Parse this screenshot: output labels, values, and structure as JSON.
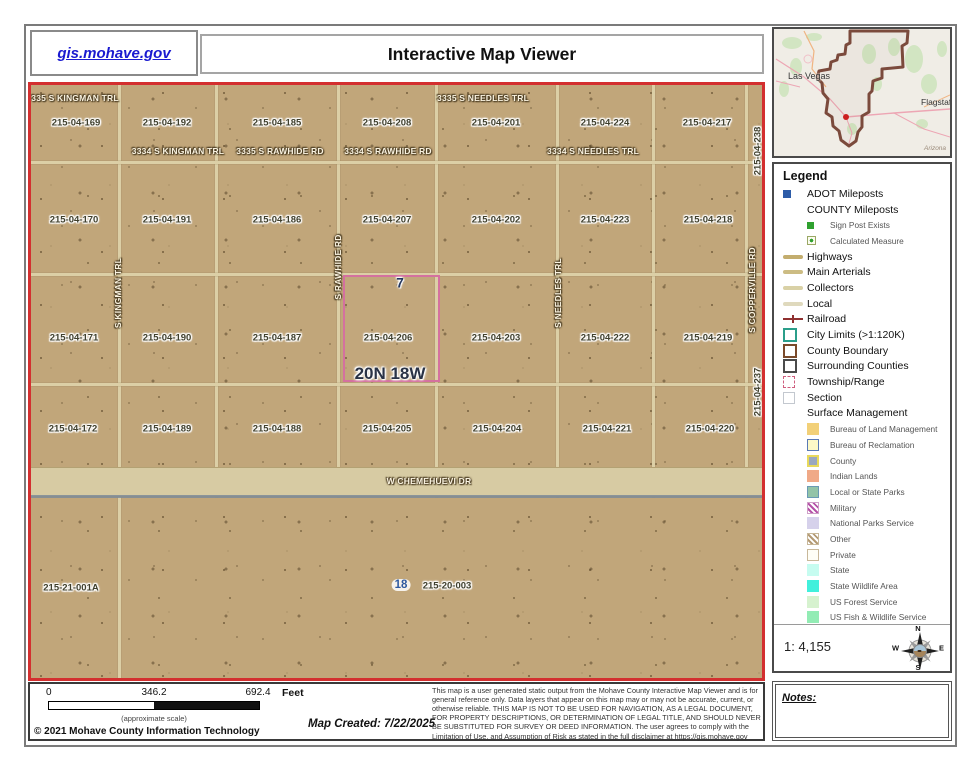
{
  "header": {
    "site_link": "gis.mohave.gov",
    "title": "Interactive Map Viewer"
  },
  "overview": {
    "city": "Las Vegas",
    "city_right": "Flagstaff",
    "state": "Arizona"
  },
  "colors": {
    "map_border": "#d32f2f",
    "township_pink": "#d4719f",
    "county_outline": "#7b4a3c",
    "marker_red": "#cc1f1f"
  },
  "legend": {
    "title": "Legend",
    "scale_text": "1: 4,155",
    "items": [
      {
        "label": "ADOT Mileposts",
        "swatch": {
          "kind": "sqs2",
          "name": "adot-milepost-swatch",
          "css": "background:#2d5ca8"
        }
      },
      {
        "label": "COUNTY Mileposts",
        "swatch": null
      },
      {
        "label": "Sign Post Exists",
        "indent": 1,
        "small": true,
        "swatch": {
          "kind": "sqs",
          "name": "sign-post-swatch",
          "css": "background:#2fa12f"
        }
      },
      {
        "label": "Calculated Measure",
        "indent": 1,
        "small": true,
        "swatch": {
          "kind": "sqs",
          "name": "calculated-measure-swatch",
          "css": "border:1px solid #9aa865;background-color:#fbfbef;background-image:radial-gradient(circle 2px at 50% 50%,#2fa12f 85%,rgba(0,0,0,0) 95%)"
        }
      },
      {
        "label": "Highways",
        "swatch": {
          "kind": "line",
          "name": "highways-swatch",
          "css": "background:#c3ad6e"
        }
      },
      {
        "label": "Main Arterials",
        "swatch": {
          "kind": "line",
          "name": "main-arterials-swatch",
          "css": "background:#ccbc83"
        }
      },
      {
        "label": "Collectors",
        "swatch": {
          "kind": "line",
          "name": "collectors-swatch",
          "css": "background:#d9d1a6"
        }
      },
      {
        "label": "Local",
        "swatch": {
          "kind": "line",
          "name": "local-swatch",
          "css": "background:#dfd9bd"
        }
      },
      {
        "label": "Railroad",
        "swatch": {
          "kind": "rail",
          "name": "railroad-swatch",
          "css": "background:#8f3030"
        }
      },
      {
        "label": "City Limits (>1:120K)",
        "swatch": {
          "kind": "osq",
          "name": "city-limits-swatch",
          "css": "border-color:#2b9e8a"
        }
      },
      {
        "label": "County Boundary",
        "swatch": {
          "kind": "osq",
          "name": "county-boundary-swatch",
          "css": "border-color:#7a4a2a"
        }
      },
      {
        "label": "Surrounding Counties",
        "swatch": {
          "kind": "osq",
          "name": "surrounding-counties-swatch",
          "css": "border-color:#4a4a4a"
        }
      },
      {
        "label": "Township/Range",
        "swatch": {
          "kind": "osq",
          "name": "township-range-swatch",
          "css": "border-color:#cf5f7f;border-width:1px;border-style:dashed"
        }
      },
      {
        "label": "Section",
        "swatch": {
          "kind": "osq",
          "name": "section-swatch",
          "css": "border-color:#c3c8cf;border-width:1px"
        }
      },
      {
        "label": "Surface Management",
        "heading": true,
        "swatch": null
      },
      {
        "label": "Bureau of Land Management",
        "indent": 1,
        "small": true,
        "swatch": {
          "kind": "sqm",
          "name": "blm-swatch",
          "css": "background:#f2d078"
        }
      },
      {
        "label": "Bureau of Reclamation",
        "indent": 1,
        "small": true,
        "swatch": {
          "kind": "sqm",
          "name": "bureau-reclamation-swatch",
          "css": "background:#fdf9c8;border:1px solid #5a7ab5"
        }
      },
      {
        "label": "County",
        "indent": 1,
        "small": true,
        "swatch": {
          "kind": "sqm",
          "name": "county-swatch",
          "css": "background:#9aa8bf;border:2px solid #e8d95c"
        }
      },
      {
        "label": "Indian Lands",
        "indent": 1,
        "small": true,
        "swatch": {
          "kind": "sqm",
          "name": "indian-lands-swatch",
          "css": "background:#f0a987"
        }
      },
      {
        "label": "Local or State Parks",
        "indent": 1,
        "small": true,
        "swatch": {
          "kind": "sqm",
          "name": "state-parks-swatch",
          "css": "background:#93c4a8;border:1px solid #6a9ab5"
        }
      },
      {
        "label": "Military",
        "indent": 1,
        "small": true,
        "swatch": {
          "kind": "sqm",
          "name": "military-swatch",
          "css": "background:repeating-linear-gradient(45deg,#fff 0 2px,#b553a8 2px 4px);border:1px solid #cfa0c8"
        }
      },
      {
        "label": "National Parks Service",
        "indent": 1,
        "small": true,
        "swatch": {
          "kind": "sqm",
          "name": "nps-swatch",
          "css": "background:#d6d1eb"
        }
      },
      {
        "label": "Other",
        "indent": 1,
        "small": true,
        "swatch": {
          "kind": "sqm",
          "name": "other-swatch",
          "css": "background:repeating-linear-gradient(45deg,#fff 0 2px,#b49a74 2px 4px);border:1px solid #c8b89a"
        }
      },
      {
        "label": "Private",
        "indent": 1,
        "small": true,
        "swatch": {
          "kind": "sqm",
          "name": "private-swatch",
          "css": "background:#fffef6;border:1px solid #c8b89a"
        }
      },
      {
        "label": "State",
        "indent": 1,
        "small": true,
        "swatch": {
          "kind": "sqm",
          "name": "state-swatch",
          "css": "background:#c6fcf0"
        }
      },
      {
        "label": "State Wildlife Area",
        "indent": 1,
        "small": true,
        "swatch": {
          "kind": "sqm",
          "name": "state-wildlife-swatch",
          "css": "background:#41f0dc"
        }
      },
      {
        "label": "US Forest Service",
        "indent": 1,
        "small": true,
        "swatch": {
          "kind": "sqm",
          "name": "us-forest-swatch",
          "css": "background:#d6f2cf"
        }
      },
      {
        "label": "US Fish & Wildlife Service",
        "indent": 1,
        "small": true,
        "swatch": {
          "kind": "sqm",
          "name": "us-fish-wildlife-swatch",
          "css": "background:#92ecb4"
        }
      }
    ]
  },
  "compass": {
    "n": "N",
    "e": "E",
    "s": "S",
    "w": "W"
  },
  "notes": {
    "label": "Notes:"
  },
  "map": {
    "labels": [
      {
        "t": "335 S KINGMAN TRL",
        "x": 44,
        "y": 13,
        "c": "s"
      },
      {
        "t": "3335 S NEEDLES TRL",
        "x": 452,
        "y": 13,
        "c": "s"
      },
      {
        "t": "3334 S KINGMAN TRL",
        "x": 147,
        "y": 66,
        "c": "s"
      },
      {
        "t": "3335 S RAWHIDE RD",
        "x": 249,
        "y": 66,
        "c": "s"
      },
      {
        "t": "3334 S RAWHIDE RD",
        "x": 357,
        "y": 66,
        "c": "s"
      },
      {
        "t": "3334 S NEEDLES TRL",
        "x": 562,
        "y": 66,
        "c": "s"
      },
      {
        "t": "W CHEMEHUEVI DR",
        "x": 398,
        "y": 396,
        "c": "s"
      },
      {
        "t": "S KINGMAN TRL",
        "x": 87,
        "y": 208,
        "c": "s v"
      },
      {
        "t": "S RAWHIDE RD",
        "x": 307,
        "y": 182,
        "c": "s v"
      },
      {
        "t": "S NEEDLES TRL",
        "x": 527,
        "y": 208,
        "c": "s v"
      },
      {
        "t": "S COPPERVILLE RD",
        "x": 721,
        "y": 205,
        "c": "s v"
      },
      {
        "t": "215-04-169",
        "x": 45,
        "y": 38,
        "c": "p"
      },
      {
        "t": "215-04-192",
        "x": 136,
        "y": 38,
        "c": "p"
      },
      {
        "t": "215-04-185",
        "x": 246,
        "y": 38,
        "c": "p"
      },
      {
        "t": "215-04-208",
        "x": 356,
        "y": 38,
        "c": "p"
      },
      {
        "t": "215-04-201",
        "x": 465,
        "y": 38,
        "c": "p"
      },
      {
        "t": "215-04-224",
        "x": 574,
        "y": 38,
        "c": "p"
      },
      {
        "t": "215-04-217",
        "x": 676,
        "y": 38,
        "c": "p"
      },
      {
        "t": "215-04-170",
        "x": 43,
        "y": 135,
        "c": "p"
      },
      {
        "t": "215-04-191",
        "x": 136,
        "y": 135,
        "c": "p"
      },
      {
        "t": "215-04-186",
        "x": 246,
        "y": 135,
        "c": "p"
      },
      {
        "t": "215-04-207",
        "x": 356,
        "y": 135,
        "c": "p"
      },
      {
        "t": "215-04-202",
        "x": 465,
        "y": 135,
        "c": "p"
      },
      {
        "t": "215-04-223",
        "x": 574,
        "y": 135,
        "c": "p"
      },
      {
        "t": "215-04-218",
        "x": 677,
        "y": 135,
        "c": "p"
      },
      {
        "t": "215-04-171",
        "x": 43,
        "y": 253,
        "c": "p"
      },
      {
        "t": "215-04-190",
        "x": 136,
        "y": 253,
        "c": "p"
      },
      {
        "t": "215-04-187",
        "x": 246,
        "y": 253,
        "c": "p"
      },
      {
        "t": "215-04-206",
        "x": 357,
        "y": 253,
        "c": "p"
      },
      {
        "t": "215-04-203",
        "x": 465,
        "y": 253,
        "c": "p"
      },
      {
        "t": "215-04-222",
        "x": 574,
        "y": 253,
        "c": "p"
      },
      {
        "t": "215-04-219",
        "x": 677,
        "y": 253,
        "c": "p"
      },
      {
        "t": "215-04-172",
        "x": 42,
        "y": 344,
        "c": "p"
      },
      {
        "t": "215-04-189",
        "x": 136,
        "y": 344,
        "c": "p"
      },
      {
        "t": "215-04-188",
        "x": 246,
        "y": 344,
        "c": "p"
      },
      {
        "t": "215-04-205",
        "x": 356,
        "y": 344,
        "c": "p"
      },
      {
        "t": "215-04-204",
        "x": 466,
        "y": 344,
        "c": "p"
      },
      {
        "t": "215-04-221",
        "x": 576,
        "y": 344,
        "c": "p"
      },
      {
        "t": "215-04-220",
        "x": 679,
        "y": 344,
        "c": "p"
      },
      {
        "t": "215-04-238",
        "x": 727,
        "y": 66,
        "c": "p v"
      },
      {
        "t": "215-04-237",
        "x": 727,
        "y": 307,
        "c": "p v"
      },
      {
        "t": "215-21-001A",
        "x": 40,
        "y": 503,
        "c": "p"
      },
      {
        "t": "18",
        "x": 370,
        "y": 500,
        "c": "secnum"
      },
      {
        "t": "215-20-003",
        "x": 416,
        "y": 501,
        "c": "p"
      },
      {
        "t": "7",
        "x": 369,
        "y": 198,
        "c": "sec7"
      },
      {
        "t": "20N 18W",
        "x": 359,
        "y": 289,
        "c": "twp"
      }
    ]
  },
  "footer": {
    "ticks": [
      "0",
      "346.2",
      "692.4"
    ],
    "unit": "Feet",
    "approx": "(approximate scale)",
    "copyright": "© 2021 Mohave County Information Technology",
    "created": "Map Created: 7/22/2025",
    "disclaimer": "This map is a user generated static output from the Mohave County Interactive Map Viewer and is for general reference only. Data layers that appear on this map may or may not be accurate, current, or otherwise reliable. THIS MAP IS NOT TO BE USED FOR NAVIGATION, AS A LEGAL DOCUMENT, FOR PROPERTY DESCRIPTIONS, OR DETERMINATION OF LEGAL TITLE, AND SHOULD NEVER BE SUBSTITUTED FOR SURVEY OR DEED INFORMATION. The user agrees to comply with the Limitation of Use, and Assumption of Risk as stated in the full disclaimer at https://gis.mohave.gov"
  }
}
